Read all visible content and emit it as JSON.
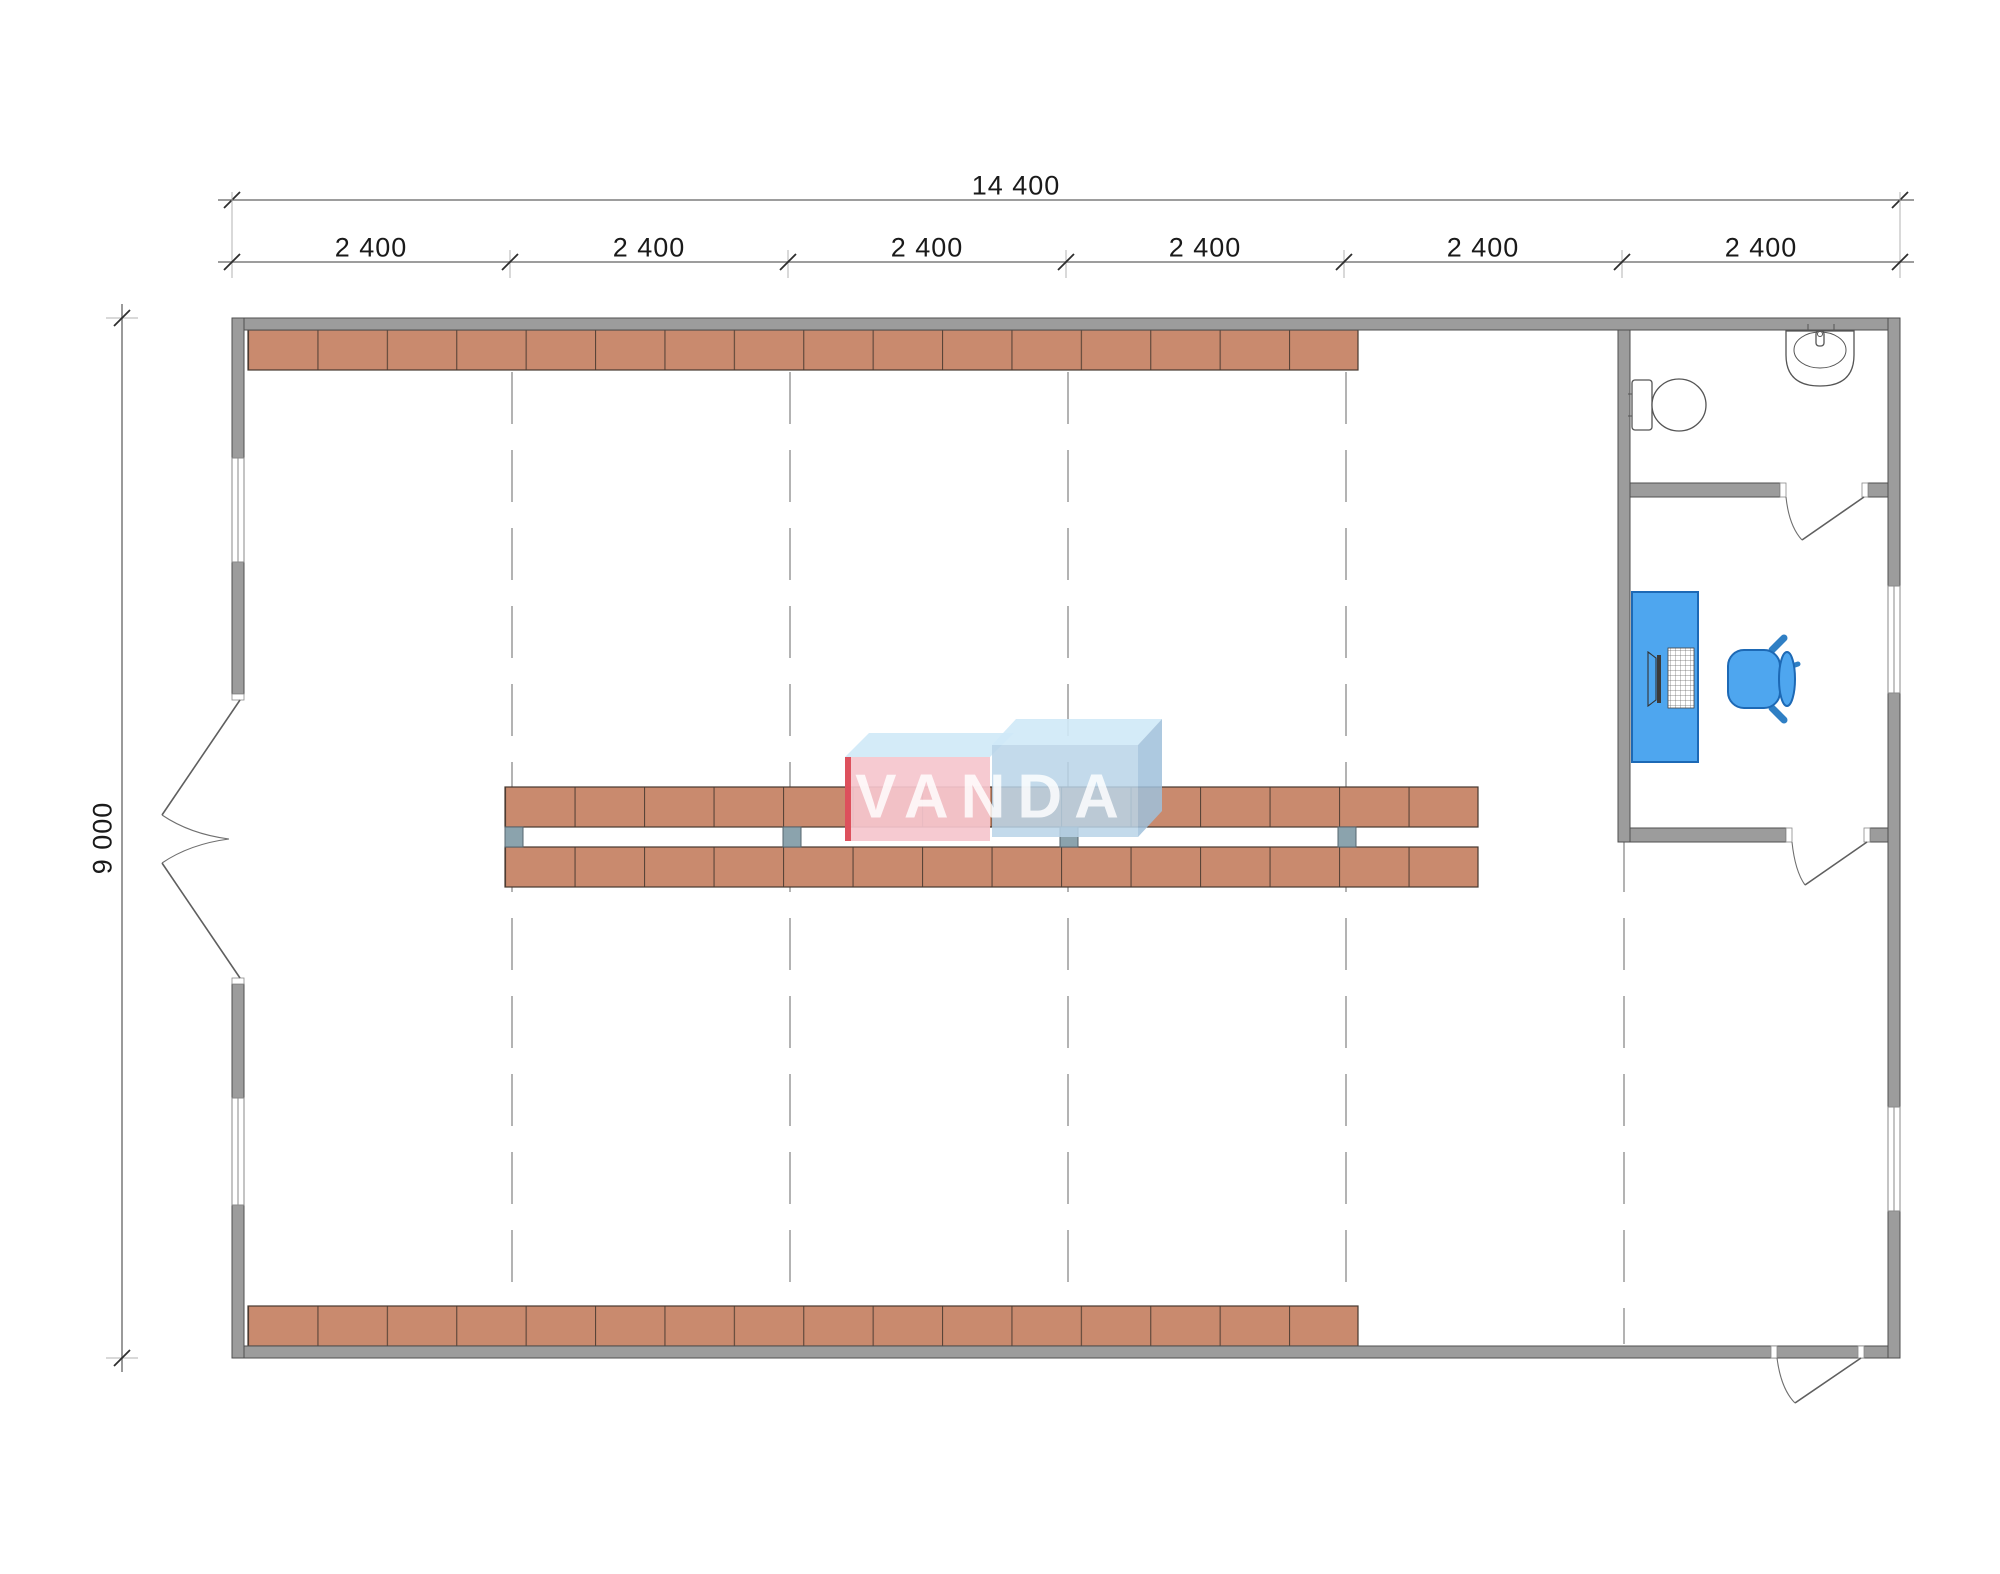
{
  "dimensions": {
    "top_total": "14 400",
    "top_segments": [
      "2 400",
      "2 400",
      "2 400",
      "2 400",
      "2 400",
      "2 400"
    ],
    "left_height": "9 000"
  },
  "logo": {
    "text": "VANDA"
  },
  "palette": {
    "wall_fill": "#9c9c9c",
    "wall_stroke": "#4f4f4f",
    "shelf_fill": "#c98a6e",
    "rack_post": "#8ba3ad",
    "furniture_blue": "#4ea6ef",
    "logo_pink": "#f5c6cd",
    "logo_blue_face": "#b9d3e8",
    "logo_sky": "#cfe9f7",
    "logo_red": "#da4450",
    "dimension_text": "#1a1a1a"
  }
}
